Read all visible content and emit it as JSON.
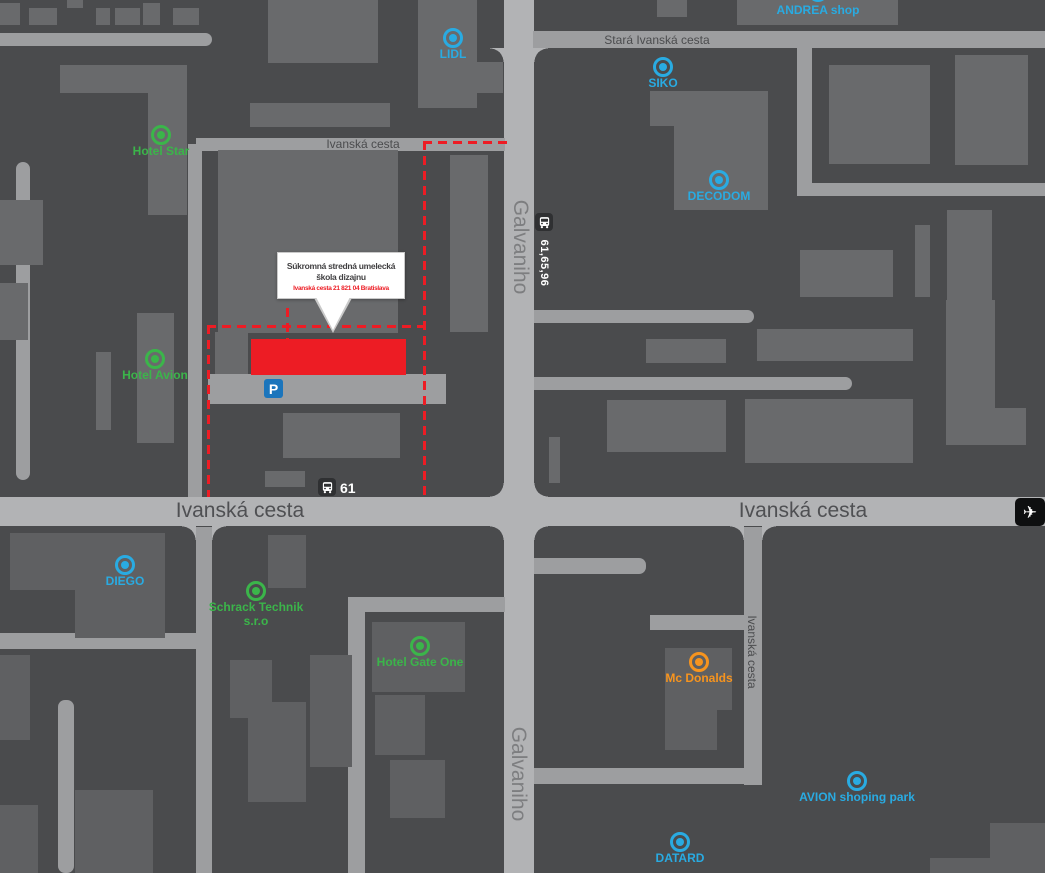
{
  "colors": {
    "background": "#4a4b4d",
    "building": "#696a6c",
    "building_dark": "#5f6062",
    "road": "#9d9ea0",
    "road_main": "#b2b3b5",
    "poi_blue": "#29abe2",
    "poi_green": "#3bb54a",
    "poi_orange": "#f7941e",
    "highlight_red": "#ed1c24",
    "parking_blue": "#1b75bc",
    "icon_dark": "#2f3032"
  },
  "roads": {
    "main_left": "Ivanská cesta",
    "main_right": "Ivanská cesta",
    "top_small": "Ivanská cesta",
    "stara": "Stará Ivanská cesta",
    "galvaniho_top": "Galvaniho",
    "galvaniho_bottom": "Galvaniho",
    "side_vertical": "Ivanská cesta"
  },
  "school": {
    "name": "Súkromná stredná umelecká škola dizajnu",
    "address": "Ivanská cesta 21 821 04 Bratislava"
  },
  "transit": {
    "main_stop_routes": "61,65,96",
    "school_stop_route": "61",
    "parking_symbol": "P",
    "airplane_symbol": "✈"
  },
  "icons": {
    "bus": "bus-front-shape",
    "parking": "blue square with white P",
    "airplane": "black square with white plane",
    "map_pin": "double ring circle"
  },
  "pois": [
    {
      "id": "hotel-star",
      "label": "Hotel Star",
      "color": "#3bb54a"
    },
    {
      "id": "lidl",
      "label": "LIDL",
      "color": "#29abe2"
    },
    {
      "id": "andrea-shop",
      "label": "ANDREA shop",
      "color": "#29abe2"
    },
    {
      "id": "siko",
      "label": "SIKO",
      "color": "#29abe2"
    },
    {
      "id": "decodom",
      "label": "DECODOM",
      "color": "#29abe2"
    },
    {
      "id": "hotel-avion",
      "label": "Hotel Avion",
      "color": "#3bb54a"
    },
    {
      "id": "diego",
      "label": "DIEGO",
      "color": "#29abe2"
    },
    {
      "id": "schrack-technik",
      "label": "Schrack Technik",
      "label2": "s.r.o",
      "color": "#3bb54a"
    },
    {
      "id": "hotel-gate-one",
      "label": "Hotel Gate One",
      "color": "#3bb54a"
    },
    {
      "id": "mc-donalds",
      "label": "Mc Donalds",
      "color": "#f7941e"
    },
    {
      "id": "avion-shoping-park",
      "label": "AVION shoping park",
      "color": "#29abe2"
    },
    {
      "id": "datard",
      "label": "DATARD",
      "color": "#29abe2"
    }
  ]
}
